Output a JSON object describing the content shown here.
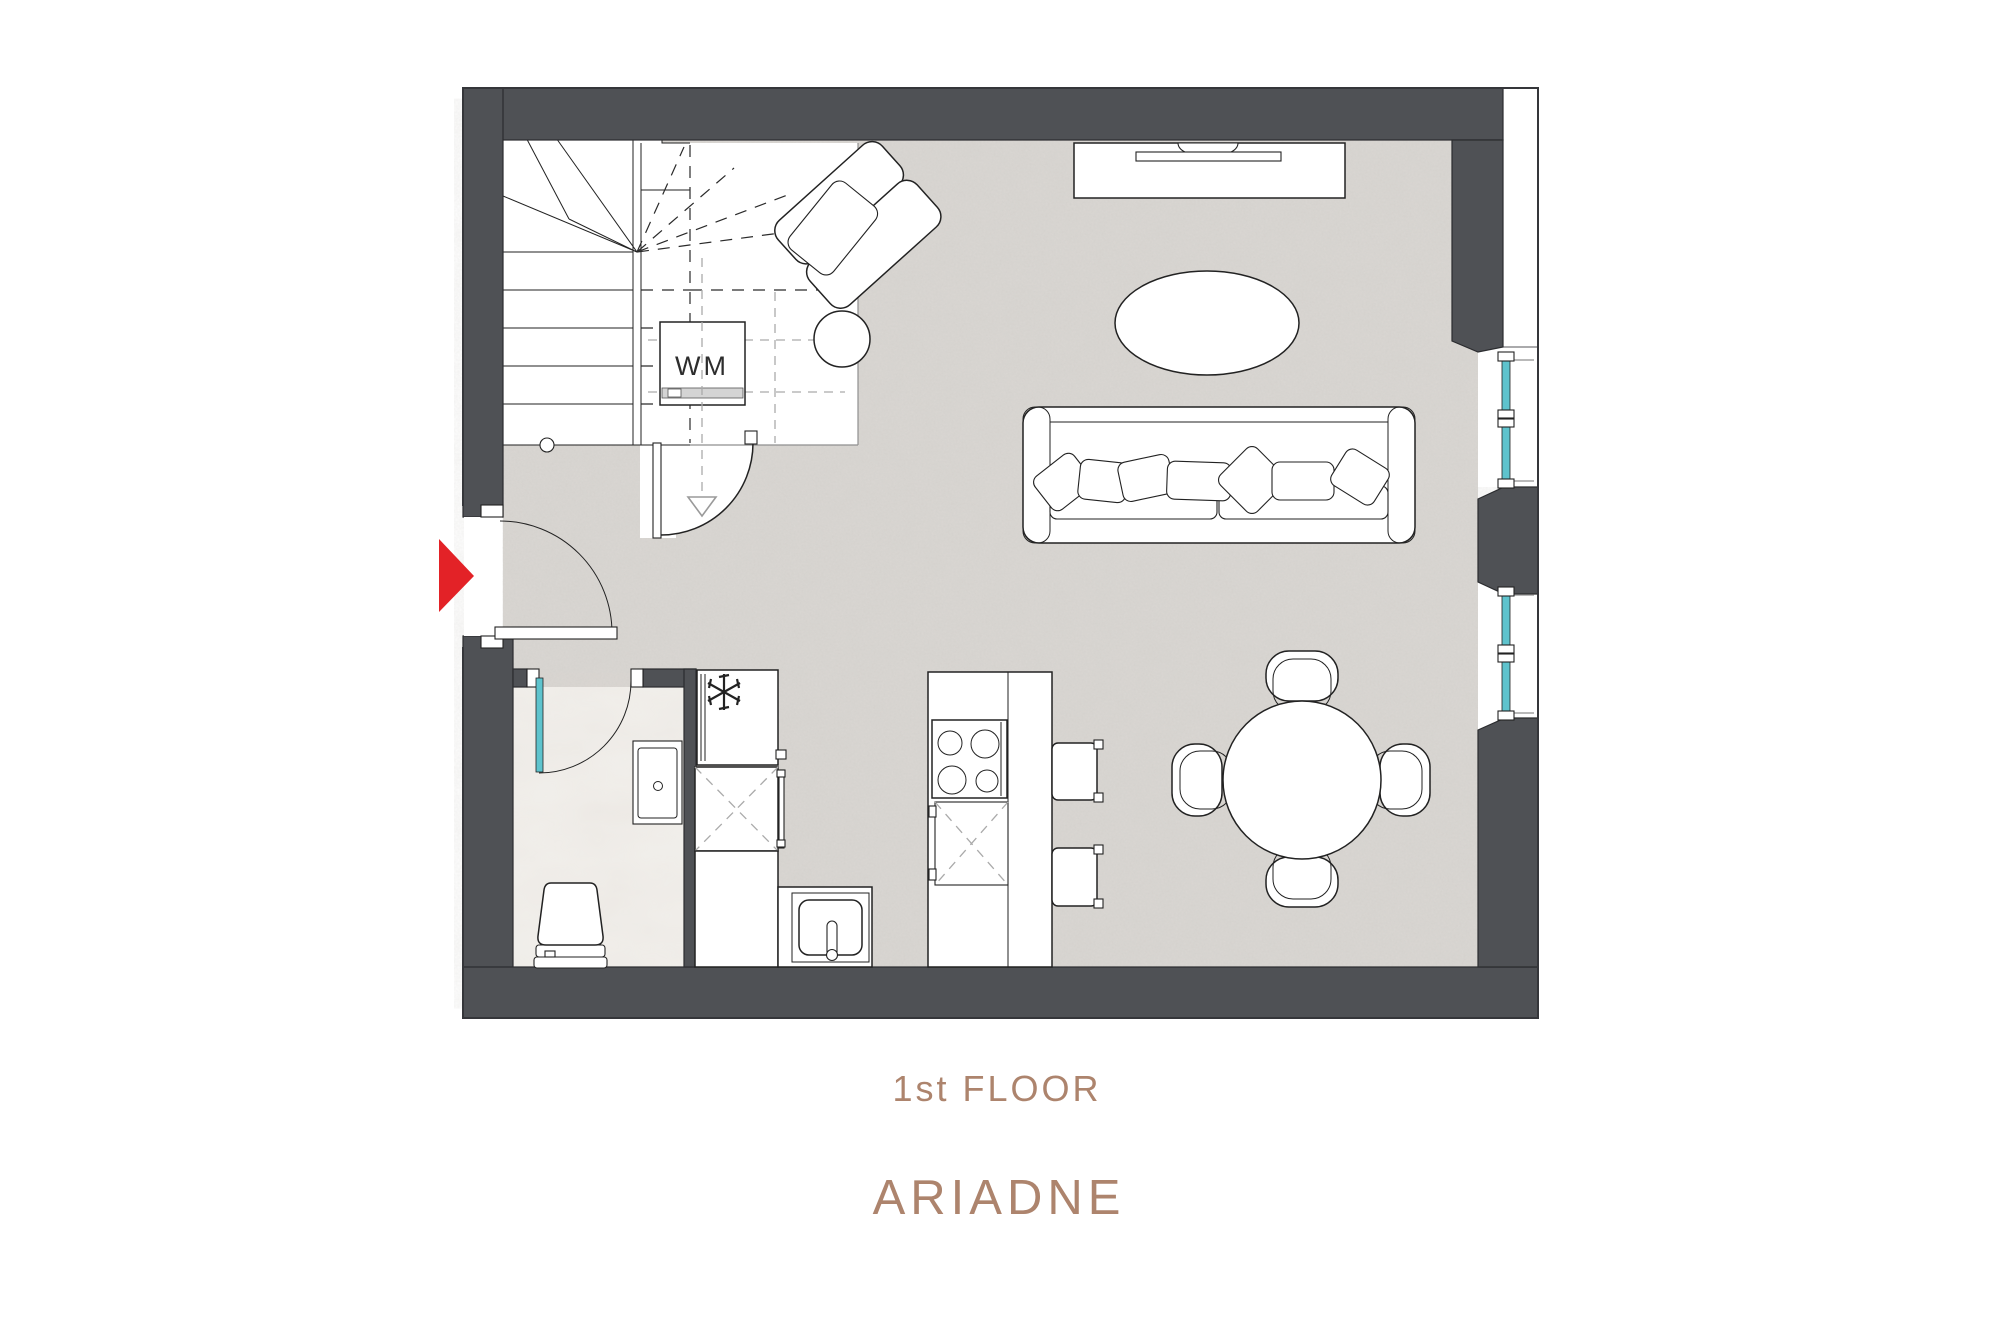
{
  "title": {
    "floor_label": "1st FLOOR",
    "plan_name": "ARIADNE"
  },
  "labels": {
    "washing_machine": "WM"
  },
  "colors": {
    "wall": "#4f5155",
    "floor_base": "#d9d6d2",
    "bathroom_floor": "#f2f0ec",
    "window_glass": "#5ec3cd",
    "entrance_arrow": "#e32227",
    "label_text": "#ad846d"
  },
  "icons": [
    "entrance-arrow-icon",
    "freezer-snowflake-icon",
    "stair-direction-arrow-icon"
  ],
  "rooms": [
    "living-dining-area",
    "kitchen-area",
    "bathroom",
    "staircase-hall"
  ],
  "furniture": [
    "winder-staircase",
    "washing-machine",
    "under-stair-storage-door",
    "entrance-door",
    "bathroom-door",
    "toilet",
    "washbasin",
    "fridge-freezer",
    "base-cabinet",
    "kitchen-sink",
    "kitchen-island",
    "hob-4-burner",
    "bar-stool",
    "bar-stool",
    "dining-table-round",
    "dining-chair",
    "dining-chair",
    "dining-chair",
    "dining-chair",
    "sofa",
    "sofa-pillows",
    "coffee-table-oval",
    "armchair",
    "side-table-round",
    "tv-console",
    "tv",
    "window",
    "window"
  ]
}
